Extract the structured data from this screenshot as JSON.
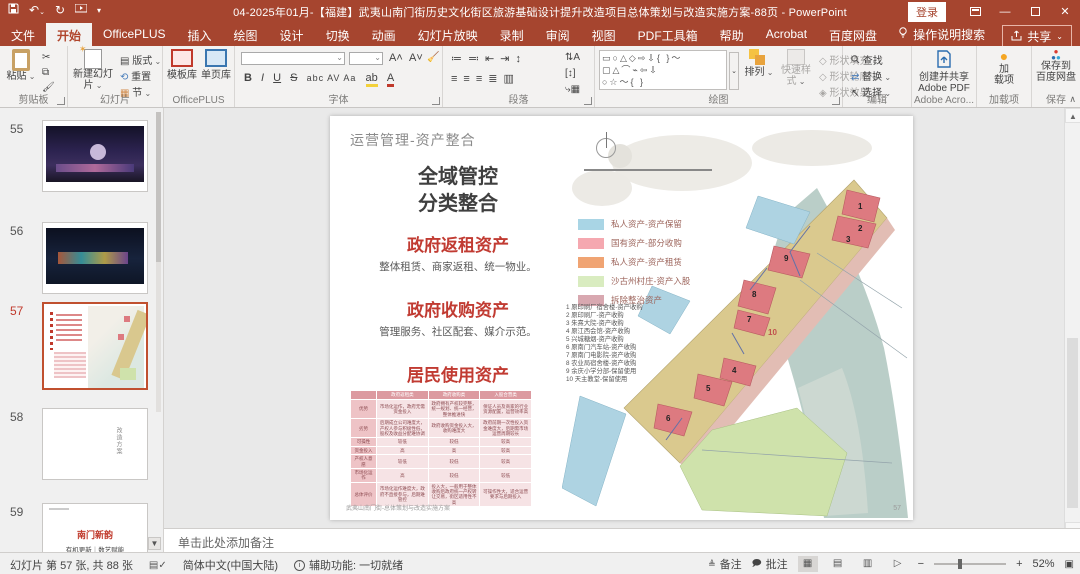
{
  "titlebar": {
    "title": "04-2025年01月-【福建】武夷山南门街历史文化街区旅游基础设计提升改造项目总体策划与改造实施方案-88页 - PowerPoint",
    "login": "登录"
  },
  "menu": {
    "tabs": [
      "文件",
      "开始",
      "OfficePLUS",
      "插入",
      "绘图",
      "设计",
      "切换",
      "动画",
      "幻灯片放映",
      "录制",
      "审阅",
      "视图",
      "PDF工具箱",
      "帮助",
      "Acrobat",
      "百度网盘"
    ],
    "selected_tab": "开始",
    "search": "操作说明搜索",
    "share": "共享"
  },
  "ribbon": {
    "clipboard": {
      "label": "剪贴板",
      "paste": "粘贴"
    },
    "slides": {
      "label": "幻灯片",
      "new_slide": "新建幻灯片",
      "layout": "版式",
      "reset": "重置",
      "section": "节"
    },
    "officeplus": {
      "label": "OfficePLUS",
      "template": "模板库",
      "page": "单页库"
    },
    "font": {
      "label": "字体",
      "bold": "B",
      "italic": "I",
      "underline": "U",
      "strike": "S",
      "chars": "abc  AV  Aa",
      "color": "A"
    },
    "paragraph": {
      "label": "段落"
    },
    "drawing": {
      "label": "绘图",
      "arrange": "排列",
      "quick_styles": "快速样式",
      "fill": "形状填充",
      "outline": "形状轮廓",
      "effects": "形状效果",
      "shapes": "▭○△◇⇨⇩{ }〜"
    },
    "editing": {
      "label": "编辑",
      "find": "查找",
      "replace": "替换",
      "select": "选择"
    },
    "acrobat": {
      "label": "Adobe Acro...",
      "line1": "创建并共享",
      "line2": "Adobe PDF"
    },
    "addins": {
      "label": "加载项",
      "btn1": "加",
      "btn2": "载项"
    },
    "save": {
      "label": "保存",
      "btn1": "保存到",
      "btn2": "百度网盘"
    }
  },
  "thumbnails": [
    {
      "num": "55"
    },
    {
      "num": "56"
    },
    {
      "num": "57"
    },
    {
      "num": "58",
      "text": "改造方案"
    },
    {
      "num": "59",
      "title": "南门新韵",
      "subtitle": "有机更新｜数艺赋能"
    }
  ],
  "slide": {
    "title": "运营管理-资产整合",
    "headline1": "全域管控",
    "headline2": "分类整合",
    "sections": [
      {
        "title": "政府返租资产",
        "desc": "整体租赁、商家返租、统一物业。"
      },
      {
        "title": "政府收购资产",
        "desc": "管理服务、社区配套、媒介示范。"
      },
      {
        "title": "居民使用资产",
        "desc": "居民自住、居民自营、统一管控。"
      },
      {
        "title": "入股合营资产",
        "desc": "资产入股、市场运作、村民分红。"
      }
    ],
    "table": {
      "rows": [
        [
          "",
          "政府返租类",
          "政府收购类",
          "入股合营类"
        ],
        [
          "优势",
          "市场化运作，政府无需资金投入",
          "政府拥有产权较完整，统一规划、统一经营，整体推进快",
          "保证人员及商家的行业资源配置，运营效率高"
        ],
        [
          "劣势",
          "后期成立公司难度大，产权人参与积极性低，股权及收益分配难协调",
          "政府收购资金投入大，收购难度大",
          "政府前期一次性投入资金难度大，后期需市场运营周期较长"
        ],
        [
          "可操性",
          "较低",
          "较低",
          "较高"
        ],
        [
          "资金投入",
          "高",
          "高",
          "较高"
        ],
        [
          "产权人意愿",
          "较低",
          "较低",
          "较高"
        ],
        [
          "市场化运作",
          "高",
          "较低",
          "较低"
        ],
        [
          "总体评价",
          "市场化运作难度大，政府不直接参与，后期难管控",
          "投入大，一般用于整体收购后政府统一产权转让交易，街区适用性不高",
          "可操作性大，适合运营要求与后期投入"
        ]
      ]
    },
    "legend": [
      {
        "color": "#a9d5e5",
        "label": "私人资产-资产保留"
      },
      {
        "color": "#f5a8b0",
        "label": "国有资产-部分收购"
      },
      {
        "color": "#f0a473",
        "label": "私人资产-资产租赁"
      },
      {
        "color": "#d9ecc0",
        "label": "沙古州村庄-资产入股"
      },
      {
        "color": "#d8a8b0",
        "label": "拆除整治资产"
      }
    ],
    "numbered_list": [
      "1 原印刷厂宿舍楼-资产收购",
      "2 原印刷厂-资产收购",
      "3 朱熹大院-资产收购",
      "4 原江西会馆-资产收购",
      "5 兴城糖烟-资产收购",
      "6 原南门汽车站-资产收购",
      "7 原南门电影院-资产收购",
      "8 农业局宿舍楼-资产收购",
      "9 余庆小学分部-保留使用",
      "10 天主教堂-保留使用"
    ],
    "markers": [
      "1",
      "2",
      "3",
      "4",
      "5",
      "6",
      "7",
      "8",
      "9",
      "10"
    ],
    "footer": "武夷山南门街-总体策划与改造实施方案",
    "page_num": "57"
  },
  "notes": {
    "placeholder": "单击此处添加备注"
  },
  "statusbar": {
    "slide_info": "幻灯片 第 57 张, 共 88 张",
    "language": "简体中文(中国大陆)",
    "accessibility": "辅助功能: 一切就绪",
    "notes_btn": "备注",
    "comments_btn": "批注",
    "zoom": "52%"
  }
}
